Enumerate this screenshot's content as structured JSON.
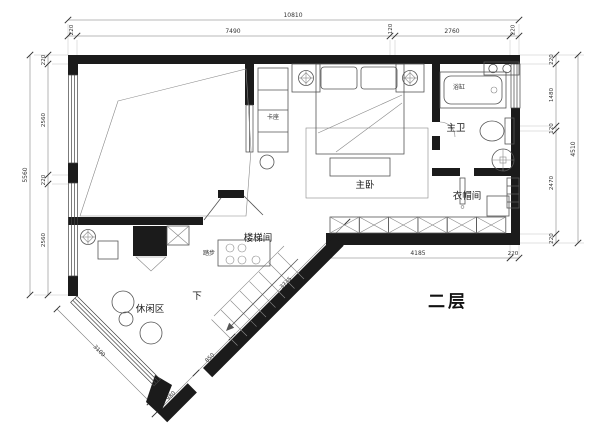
{
  "title": {
    "floor_label": "二层"
  },
  "rooms": {
    "master_bedroom": "主卧",
    "master_bath": "主卫",
    "cloakroom": "衣帽间",
    "stairwell": "楼梯间",
    "leisure_area": "休闲区"
  },
  "fixtures": {
    "bathtub": "浴缸",
    "booth_seat": "卡座",
    "steps": "踏步",
    "down": "下"
  },
  "dimensions": {
    "top": {
      "total": "10810",
      "segments": [
        "220",
        "7490",
        "120",
        "2760",
        "220"
      ]
    },
    "left": {
      "total": "5560",
      "segments": [
        "220",
        "2560",
        "220",
        "2560"
      ]
    },
    "right": {
      "total": "4510",
      "segments": [
        "220",
        "1480",
        "120",
        "2470",
        "220"
      ]
    },
    "bottom": {
      "segments": [
        "4185",
        "220"
      ]
    },
    "diagonal_left": {
      "segments": [
        "3100"
      ]
    },
    "diagonal_right": {
      "segments": [
        "980",
        "850",
        "3735"
      ]
    }
  },
  "colors": {
    "wall": "#1b1b1b",
    "furniture_line": "#555555",
    "dimension_line": "#777777",
    "text": "#333333",
    "background": "#ffffff"
  }
}
